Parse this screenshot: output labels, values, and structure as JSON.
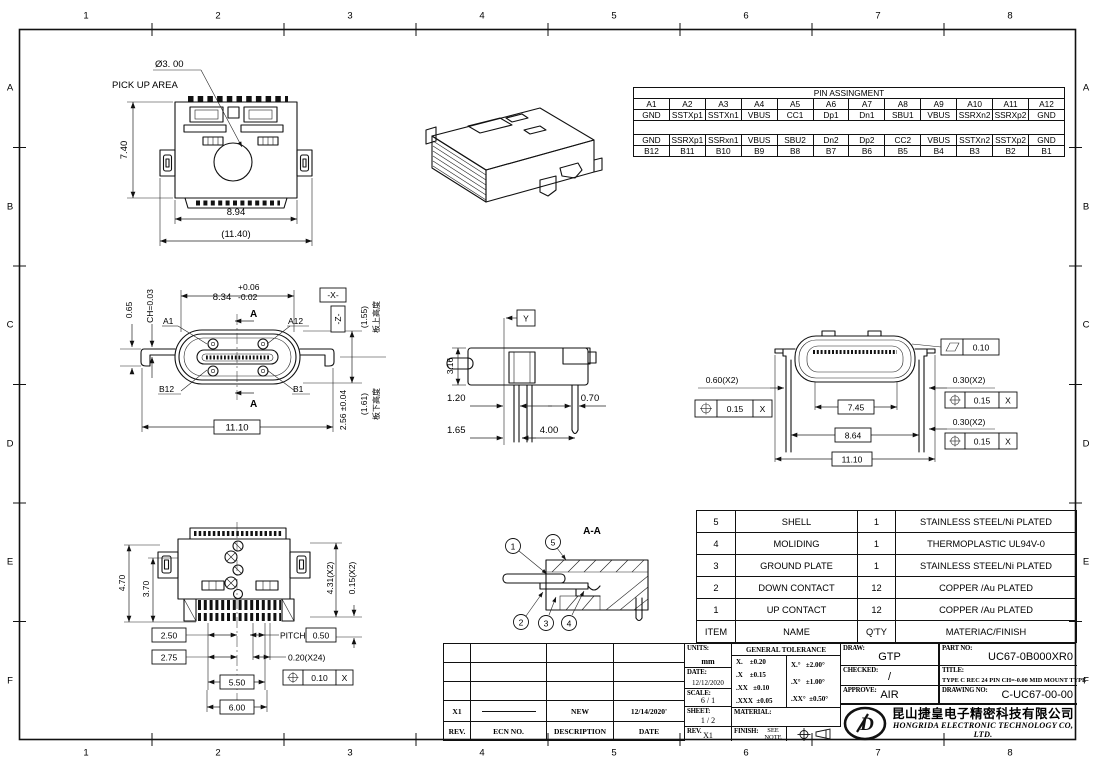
{
  "frame": {
    "cols": [
      "1",
      "2",
      "3",
      "4",
      "5",
      "6",
      "7",
      "8"
    ],
    "rows": [
      "A",
      "B",
      "C",
      "D",
      "E",
      "F"
    ]
  },
  "pin_table": {
    "title": "PIN ASSINGMENT",
    "cols_a": [
      "A1",
      "A2",
      "A3",
      "A4",
      "A5",
      "A6",
      "A7",
      "A8",
      "A9",
      "A10",
      "A11",
      "A12"
    ],
    "sig_a": [
      "GND",
      "SSTXp1",
      "SSTXn1",
      "VBUS",
      "CC1",
      "Dp1",
      "Dn1",
      "SBU1",
      "VBUS",
      "SSRXn2",
      "SSRXp2",
      "GND"
    ],
    "sig_b": [
      "GND",
      "SSRXp1",
      "SSRxn1",
      "VBUS",
      "SBU2",
      "Dn2",
      "Dp2",
      "CC2",
      "VBUS",
      "SSTXn2",
      "SSTXp2",
      "GND"
    ],
    "cols_b": [
      "B12",
      "B11",
      "B10",
      "B9",
      "B8",
      "B7",
      "B6",
      "B5",
      "B4",
      "B3",
      "B2",
      "B1"
    ]
  },
  "bom": {
    "header": {
      "item": "ITEM",
      "name": "NAME",
      "qty": "Q'TY",
      "material": "MATERIAC/FINISH"
    },
    "rows": [
      {
        "item": "5",
        "name": "SHELL",
        "qty": "1",
        "material": "STAINLESS STEEL/Ni PLATED"
      },
      {
        "item": "4",
        "name": "MOLIDING",
        "qty": "1",
        "material": "THERMOPLASTIC UL94V-0"
      },
      {
        "item": "3",
        "name": "GROUND PLATE",
        "qty": "1",
        "material": "STAINLESS STEEL/Ni PLATED"
      },
      {
        "item": "2",
        "name": "DOWN CONTACT",
        "qty": "12",
        "material": "COPPER /Au PLATED"
      },
      {
        "item": "1",
        "name": "UP CONTACT",
        "qty": "12",
        "material": "COPPER /Au PLATED"
      }
    ]
  },
  "revision": {
    "header": {
      "rev": "REV.",
      "ecn": "ECN NO.",
      "desc": "DESCRIPTION",
      "date": "DATE"
    },
    "rows": [
      {
        "rev": "X1",
        "desc": "NEW",
        "date": "12/14/2020'"
      }
    ]
  },
  "title_block": {
    "units_label": "UNITS:",
    "units_value": "mm",
    "date_label": "DATE:",
    "date_value": "12/12/2020",
    "scale_label": "SCALE:",
    "scale_value": "6 / 1",
    "sheet_label": "SHEET:",
    "sheet_value": "1 / 2",
    "rev_label": "REV.",
    "rev_value": "X1",
    "tolerance_title": "GENERAL TOLERANCE",
    "tol_l1": "X.    ±0.20",
    "tol_l2": ".X    ±0.15",
    "tol_l3": ".XX   ±0.10",
    "tol_l4": ".XXX  ±0.05",
    "tol_a1": "X.°   ±2.00°",
    "tol_a2": ".X°   ±1.00°",
    "tol_a3": ".XX°  ±0.50°",
    "material_label": "MATERIAL:",
    "finish_label": "FINISH:",
    "finish_value": "SEE NOTE",
    "draw_label": "DRAW:",
    "draw_value": "GTP",
    "checked_label": "CHECKED:",
    "checked_value": "/",
    "approve_label": "APPROVE:",
    "approve_value": "AIR",
    "part_no_label": "PART NO:",
    "part_no_value": "UC67-0B000XR0",
    "title_label": "TITLE:",
    "title_value": "TYPE C REC 24 PIN CH=-0.00 MID MOUNT TYPE",
    "drawing_no_label": "DRAWING NO:",
    "drawing_no_value": "C-UC67-00-00",
    "logo_text": "D",
    "company_cn": "昆山捷皇电子精密科技有限公司",
    "company_en": "HONGRIDA ELECTRONIC TECHNOLOGY CO, LTD."
  },
  "views": {
    "top_view": {
      "pickup_dia": "Ø3. 00",
      "pickup_label": "PICK UP AREA",
      "height": "7.40",
      "body_width": "8.94",
      "overall_width": "(11.40)"
    },
    "front_view": {
      "tol_plus": "+0.06",
      "width_main": "8.34",
      "tol_minus": "-0.02",
      "datum_x": "-X-",
      "chamfer": "CH=0.03",
      "lead": "0.65",
      "pin_a1": "A1",
      "pin_a12": "A12",
      "pin_b12": "B12",
      "pin_b1": "B1",
      "section_mark": "A",
      "overall_width": "11.10",
      "height": "2.56 ±0.04",
      "datum_z": "-Z-",
      "above_board": "(1.55)",
      "above_board_note": "板上高度",
      "below_board": "(1.61)",
      "below_board_note": "板下高度"
    },
    "side_view": {
      "datum_y": "Y",
      "height": "3.16",
      "d1": "1.20",
      "d2": "0.70",
      "d3": "1.65",
      "d4": "4.00"
    },
    "rear_view": {
      "flatness": "0.10",
      "lead_w1": "0.60(X2)",
      "pos_tol_1": "0.15",
      "pos_datum_1": "X",
      "w1": "7.45",
      "w2": "8.64",
      "w3": "11.10",
      "lead_w2": "0.30(X2)",
      "pos_tol_2": "0.15",
      "pos_datum_2": "X",
      "lead_w3": "0.30(X2)",
      "pos_tol_3": "0.15",
      "pos_datum_3": "X"
    },
    "bottom_view": {
      "h1": "4.70",
      "h2": "3.70",
      "h3": "4.31(X2)",
      "h4": "0.15(X2)",
      "d1": "2.50",
      "pitch_label": "PITCH",
      "pitch_val": "0.50",
      "d2": "2.75",
      "pin_w": "0.20(X24)",
      "pos_tol": "0.10",
      "pos_datum": "X",
      "d3": "5.50",
      "d4": "6.00"
    },
    "section_view": {
      "title": "A-A",
      "balloons": [
        "1",
        "2",
        "3",
        "4",
        "5"
      ]
    }
  }
}
